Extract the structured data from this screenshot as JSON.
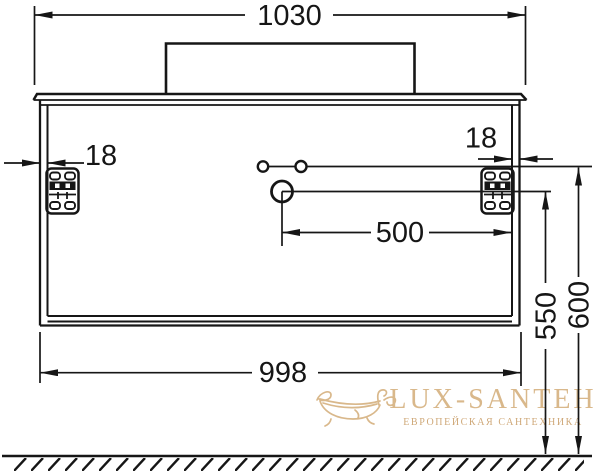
{
  "drawing": {
    "subject": "bathroom vanity cabinet front elevation technical drawing",
    "line_color": "#161616",
    "background_color": "#ffffff"
  },
  "dimensions": {
    "countertop_width": "1030",
    "left_wall_thickness": "18",
    "right_wall_thickness": "18",
    "drain_to_side": "500",
    "cabinet_width": "998",
    "drain_height": "550",
    "mounting_holes_height": "600"
  },
  "watermark": {
    "brand": "LUX-SANTEH",
    "tagline": "ЕВРОПЕЙСКАЯ САНТЕХНИКА",
    "brand_color": "#d9b88b",
    "tagline_color": "#cfa878"
  }
}
